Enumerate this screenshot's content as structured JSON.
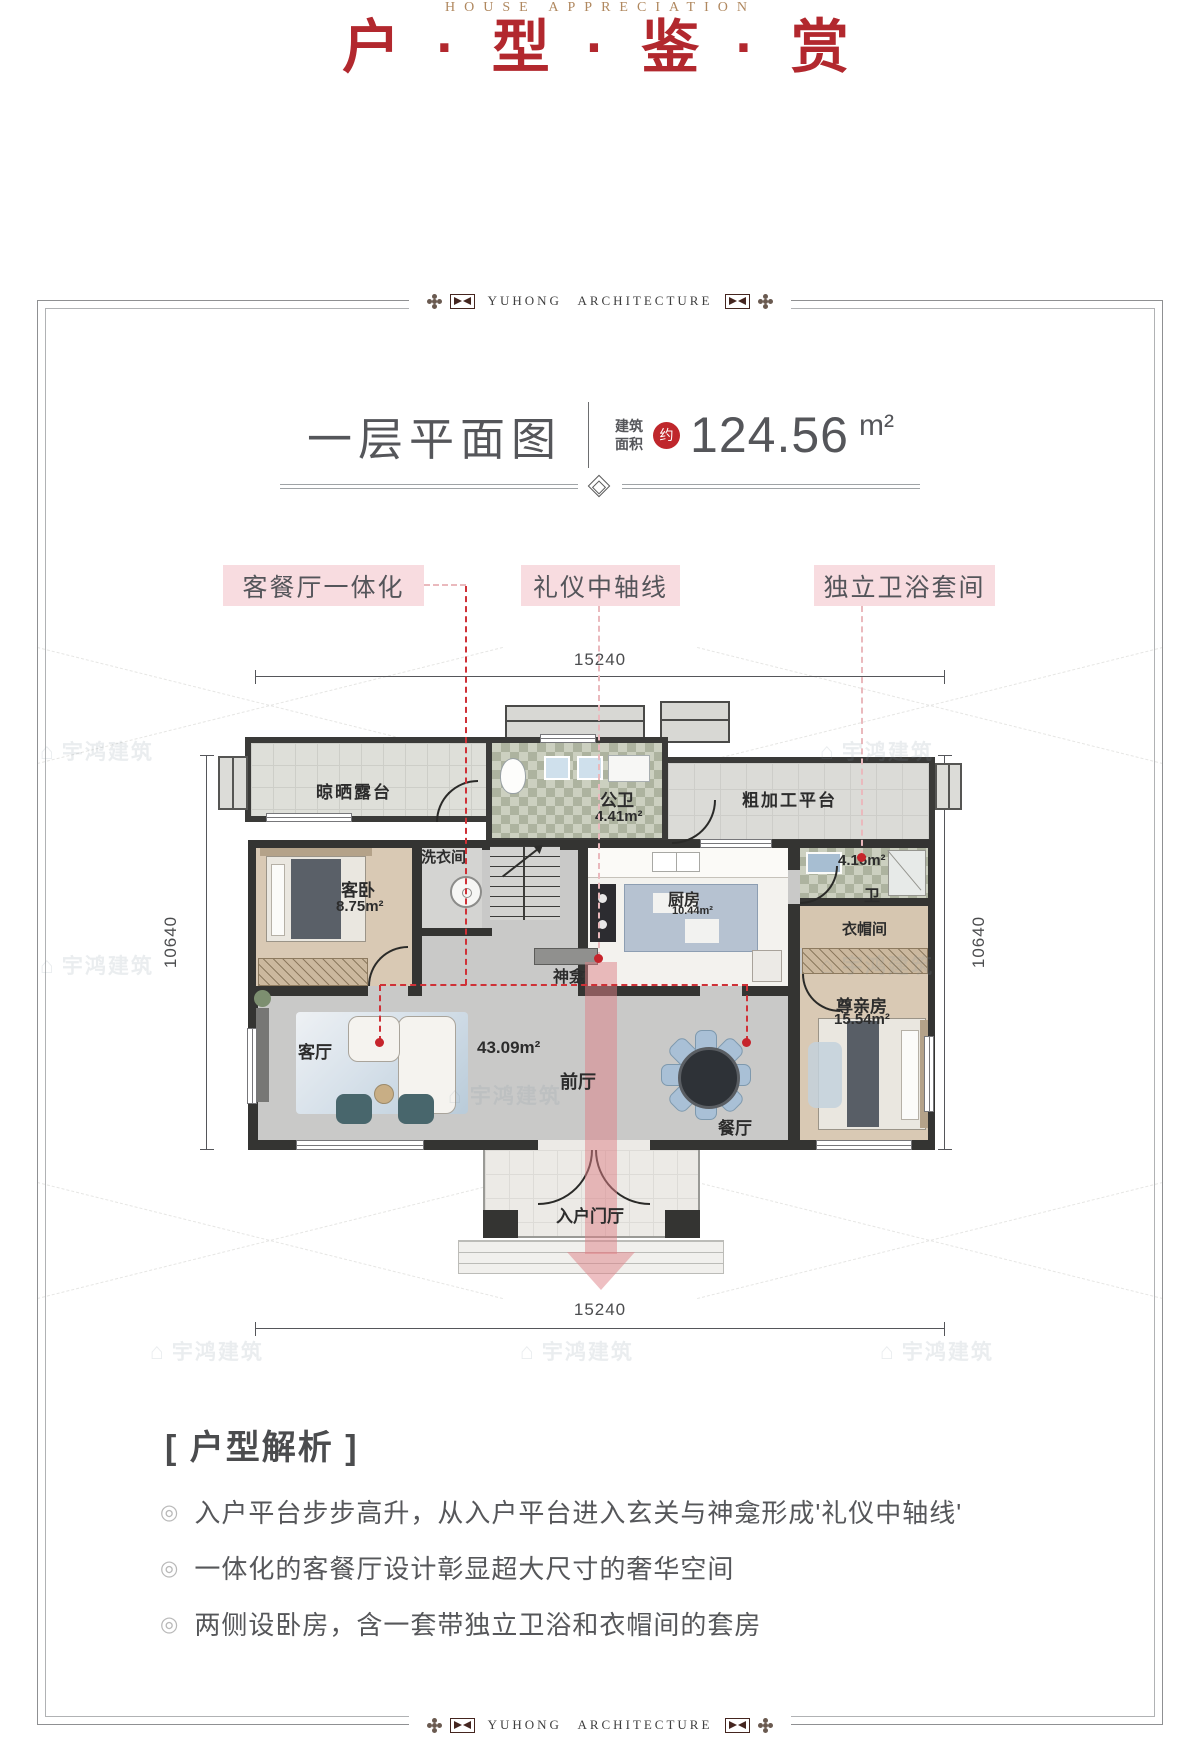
{
  "page": {
    "title": "户 · 型 · 鉴 · 赏",
    "subtitle": "HOUSE APPRECIATION"
  },
  "frame": {
    "brand": "YUHONG ARCHITECTURE"
  },
  "plan_header": {
    "title": "一层平面图",
    "area_label_top": "建筑",
    "area_label_bottom": "面积",
    "approx": "约",
    "area_value": "124.56",
    "area_unit": "m²"
  },
  "callouts": {
    "left": "客餐厅一体化",
    "center": "礼仪中轴线",
    "right": "独立卫浴套间"
  },
  "dimensions": {
    "top": "15240",
    "bottom": "15240",
    "left": "10640",
    "right": "10640"
  },
  "rooms": {
    "terrace": "晾晒露台",
    "public_bath": "公卫",
    "public_bath_area": "4.41m²",
    "platform": "粗加工平台",
    "laundry": "洗衣间",
    "guest_bedroom": "客卧",
    "guest_bedroom_area": "8.75m²",
    "kitchen": "厨房",
    "kitchen_area": "10.44m²",
    "suite_bath": "卫",
    "suite_bath_area": "4.16m²",
    "cloakroom": "衣帽间",
    "shrine": "神龛",
    "living": "客厅",
    "front_hall": "前厅",
    "front_hall_area": "43.09m²",
    "dining": "餐厅",
    "elder_room": "尊亲房",
    "elder_room_area": "15.54m²",
    "entry": "入户门厅"
  },
  "analysis": {
    "heading": "[ 户型解析 ]",
    "bullets": [
      "入户平台步步高升，从入户平台进入玄关与神龛形成'礼仪中轴线'",
      "一体化的客餐厅设计彰显超大尺寸的奢华空间",
      "两侧设卧房，含一套带独立卫浴和衣帽间的套房"
    ]
  },
  "watermark": {
    "icon": "⌂",
    "text": "宇鸿建筑"
  }
}
